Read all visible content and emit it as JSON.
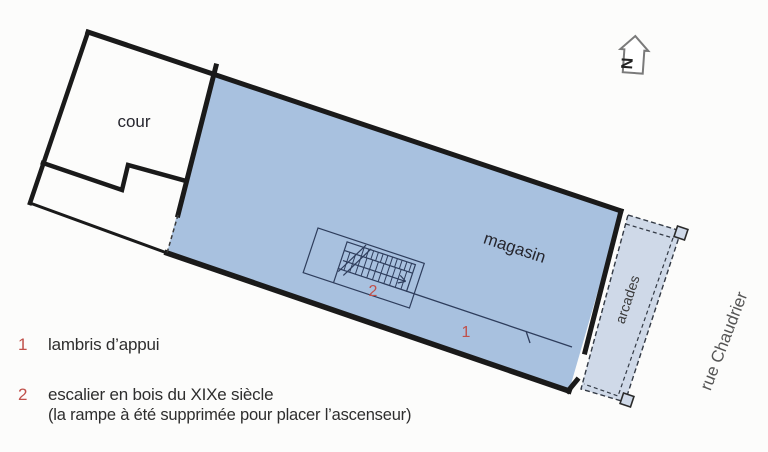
{
  "plan": {
    "labels": {
      "cour": "cour",
      "magasin": "magasin",
      "arcades": "arcades",
      "street": "rue Chaudrier",
      "north": "N"
    },
    "markers": {
      "lambris": "1",
      "escalier": "2"
    }
  },
  "legend": {
    "items": [
      {
        "num": "1",
        "text": "lambris d’appui",
        "note": ""
      },
      {
        "num": "2",
        "text": "escalier en bois du XIXe siècle",
        "note": "(la rampe à été supprimée pour placer l’ascenseur)"
      }
    ]
  },
  "colors": {
    "magasin_fill": "#a8c1df",
    "arcade_fill": "#cfd9e8",
    "wall": "#1a1a1a",
    "line": "#2e3d5c",
    "accent_red": "#c0504a",
    "text_dark": "#26262e",
    "street_grey": "#555555"
  }
}
